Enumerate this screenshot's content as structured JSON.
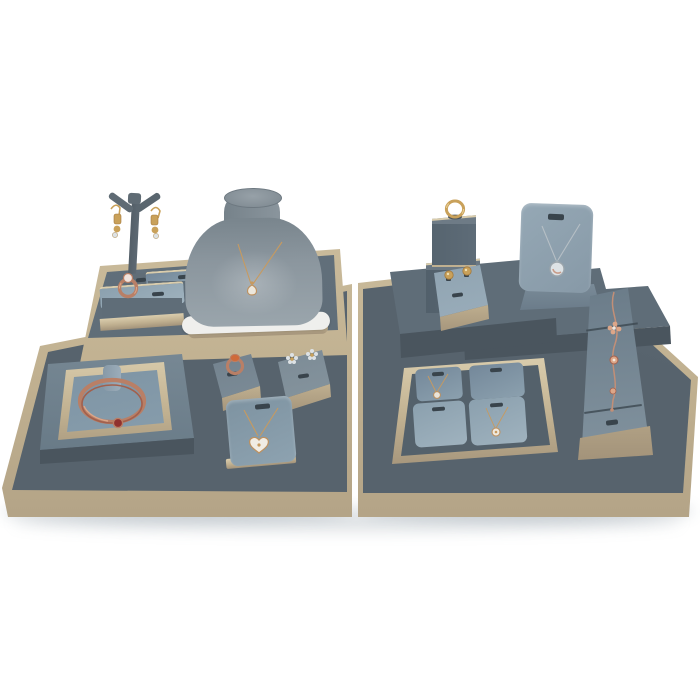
{
  "scene": {
    "description": "Product photograph of a jewelry display prop set: blue-gray leather stands with champagne gold trim on two matching display tables, holding necklaces, rings, stud and drop earrings, a bangle and a charm bracelet against a white background.",
    "items": {
      "table_left": {
        "label": "Left display table with champagne gold trim"
      },
      "table_right": {
        "label": "Right display table with champagne gold trim"
      },
      "platform_left": {
        "label": "Raised gold-trimmed platform"
      },
      "t_stand": {
        "label": "T-bar earring stand with gold drop earrings"
      },
      "ring_stand": {
        "label": "Two-step ring stand with rose gold ring"
      },
      "bust": {
        "label": "Necklace bust with gold teardrop pendant necklace"
      },
      "bangle": {
        "label": "Bangle display with rose gold bangle and red charm"
      },
      "slant_ring": {
        "label": "Slant stand with orange gemstone rose gold ring"
      },
      "slant_studs": {
        "label": "Slant stand with flower stud earrings"
      },
      "pendant_pad": {
        "label": "Pendant pad with heart pendant necklace"
      },
      "platform_a": {
        "label": "Display riser under pendant easel"
      },
      "platform_b": {
        "label": "Display riser under ring tower"
      },
      "platform_c": {
        "label": "Long display riser step"
      },
      "tower": {
        "label": "Two-tier ring tower with gold ring"
      },
      "stud_pad": {
        "label": "Slant pad with two gold stud earrings"
      },
      "easel": {
        "label": "Pendant easel with silver pendant necklace"
      },
      "ramp": {
        "label": "Bracelet ramp with rose gold charm bracelet"
      },
      "tray": {
        "label": "Gold-trimmed tray with four pendant pads, two holding necklaces"
      }
    }
  },
  "palette": {
    "bg": "#ffffff",
    "table-top": "#57636d",
    "table-top-edge": "#6a7882",
    "gold": "#c0b090",
    "gold-light": "#dacdad",
    "gold-dark": "#a3937a",
    "slab-top": "#5f6d78",
    "slab-face": "#4a555e",
    "pad": "#8ba0ae",
    "pad-light": "#9fb2be",
    "pad-dark": "#74889a",
    "pad-face": "#697d8d",
    "bust-hi": "#9aa5ac",
    "bust-lo": "#79858d",
    "white-rim": "#efefed",
    "rose": "#b97f66",
    "rose-light": "#dca688",
    "gold-metal": "#c9a15a",
    "silver": "#b6bfc5",
    "silver-light": "#dde2e5",
    "stone-red": "#90312e",
    "stone-orange": "#cf6b3a",
    "slot": "#39444c",
    "shadow": "#8a97a1"
  }
}
